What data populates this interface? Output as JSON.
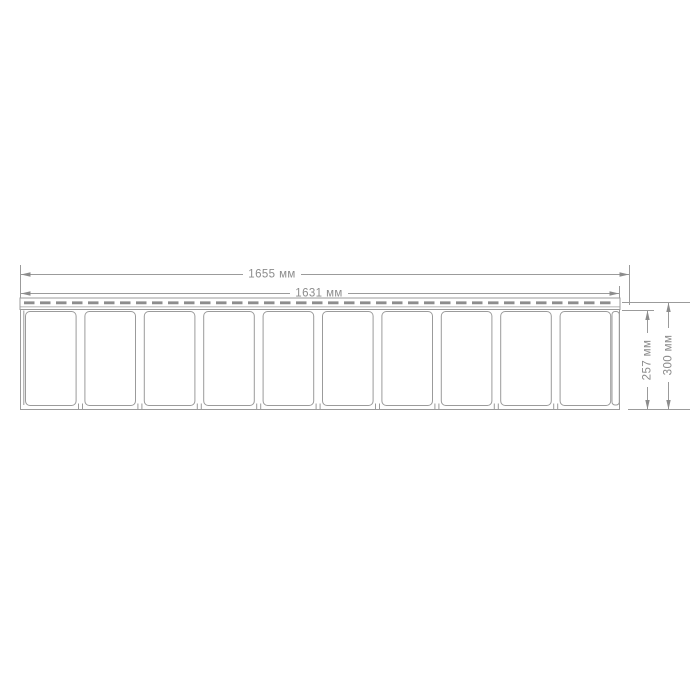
{
  "page": {
    "background": "#ffffff"
  },
  "drawing": {
    "units": "мм",
    "colors": {
      "line": "#9b9b9b",
      "dash": "#8d8d8d",
      "text": "#8c8c8c",
      "arrow": "#8c8c8c",
      "fill": "#ffffff"
    },
    "panel": {
      "sections_count": 10
    },
    "dimensions": {
      "width_outer": {
        "label": "1655 мм",
        "value": 1655
      },
      "width_inner": {
        "label": "1631 мм",
        "value": 1631
      },
      "height_panel": {
        "label": "257 мм",
        "value": 257
      },
      "height_overall": {
        "label": "300 мм",
        "value": 300
      }
    }
  }
}
